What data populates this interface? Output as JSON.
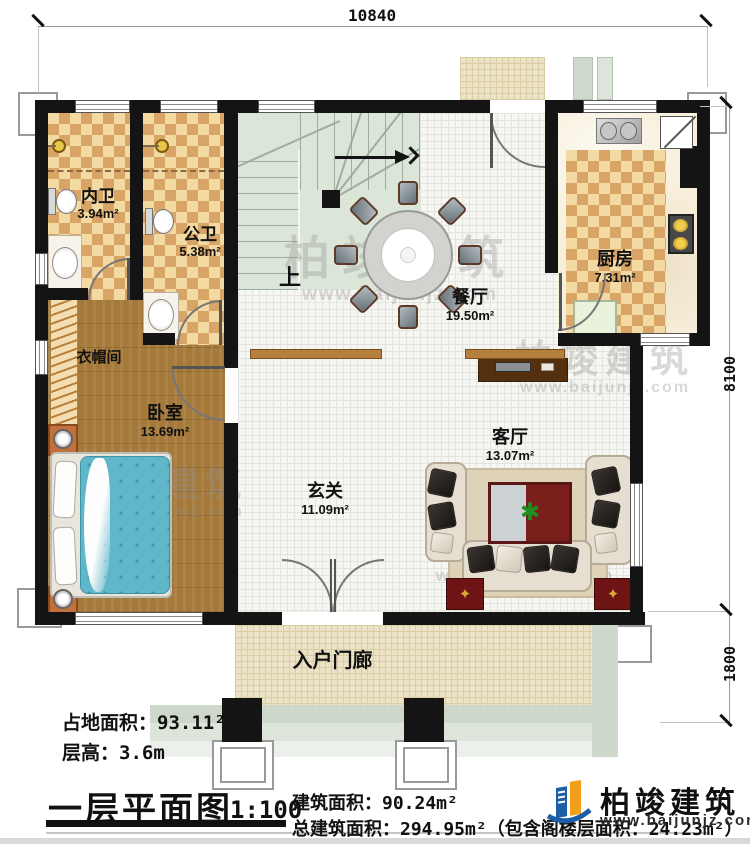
{
  "dimensions": {
    "top": "10840",
    "right_upper": "8100",
    "right_lower": "1800"
  },
  "rooms": {
    "inner_bath": {
      "name": "内卫",
      "area": "3.94m²"
    },
    "public_bath": {
      "name": "公卫",
      "area": "5.38m²"
    },
    "kitchen": {
      "name": "厨房",
      "area": "7.31m²"
    },
    "dining": {
      "name": "餐厅",
      "area": "19.50m²"
    },
    "cloakroom": {
      "name": "衣帽间"
    },
    "bedroom": {
      "name": "卧室",
      "area": "13.69m²"
    },
    "living": {
      "name": "客厅",
      "area": "13.07m²"
    },
    "entry_hall": {
      "name": "玄关",
      "area": "11.09m²"
    },
    "porch": {
      "name": "入户门廊"
    },
    "stair_up": {
      "label": "上"
    }
  },
  "info": {
    "land_area": "占地面积：93.11²",
    "floor_height": "层高：3.6m",
    "title": "一层平面图",
    "scale": "1:100",
    "building_area": "建筑面积：90.24m²",
    "total_building_area": "总建筑面积：294.95m²（包含阁楼层面积：24.23m²）"
  },
  "branding": {
    "logo_name": "柏竣建筑",
    "logo_url": "www.baijunjz.com"
  },
  "watermark": {
    "cn": "柏竣建筑",
    "en": "www.baijunjz.com"
  },
  "colors": {
    "wall": "#141414",
    "checker": "#d9a566",
    "wood": "#a5793a",
    "stair": "#dbe5d8",
    "logo_blue": "#1c5fa8",
    "logo_orange": "#f49f1c",
    "accent_red": "#6e1414",
    "bed_blue": "#5fb7c9"
  }
}
